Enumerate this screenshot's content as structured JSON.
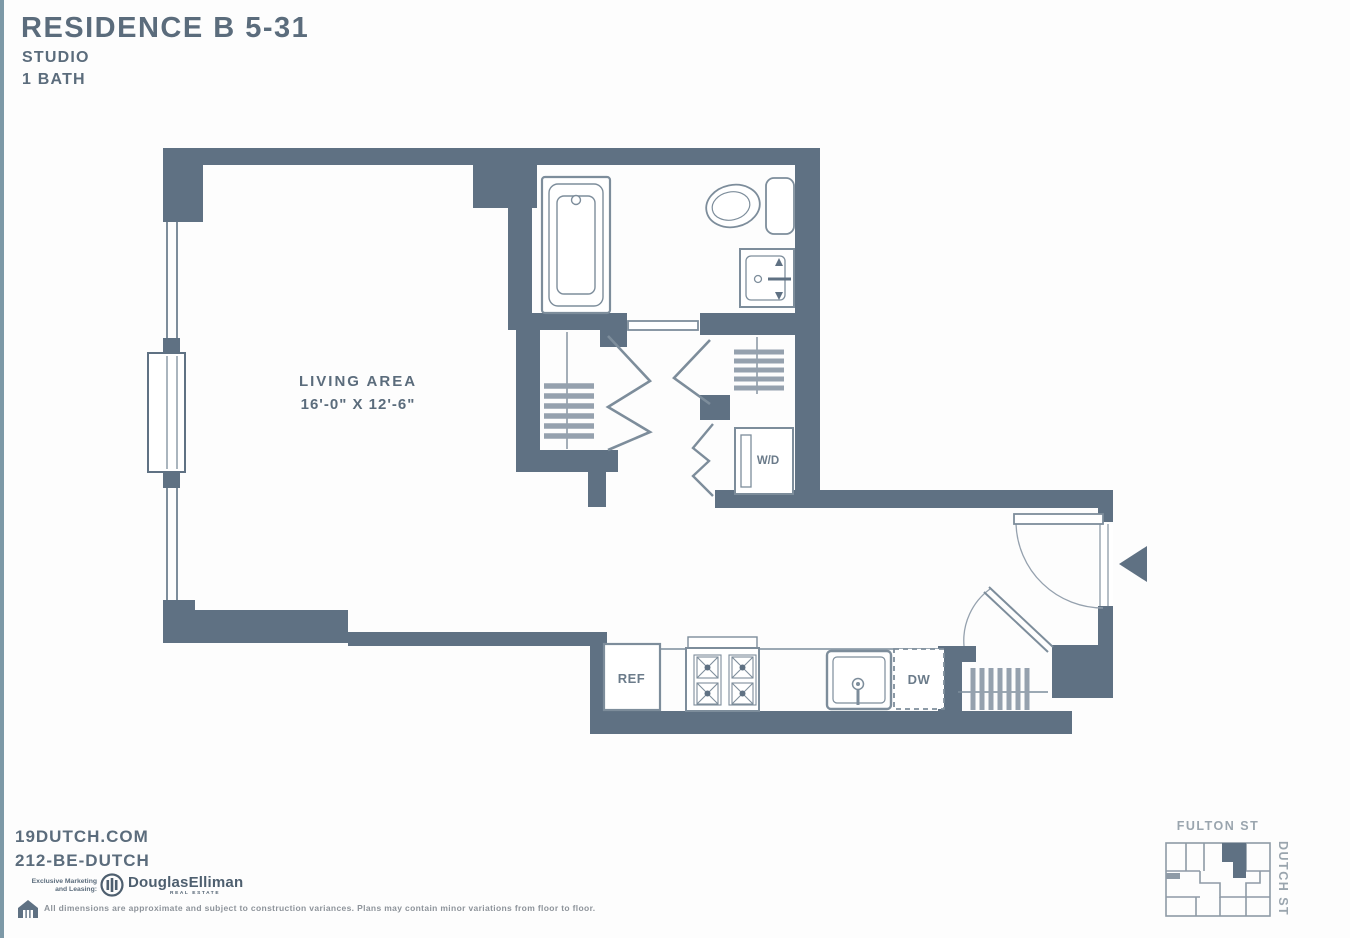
{
  "title": {
    "line1": "RESIDENCE B 5-31",
    "line2": "STUDIO",
    "line3": "1 BATH"
  },
  "plan": {
    "living_label": "LIVING AREA",
    "living_dims": "16'-0\" X 12'-6\"",
    "wd_label": "W/D",
    "ref_label": "REF",
    "dw_label": "DW"
  },
  "key_plan": {
    "street_top": "FULTON ST",
    "street_side": "DUTCH ST"
  },
  "footer": {
    "website": "19DUTCH.COM",
    "phone": "212-BE-DUTCH",
    "marketing_line1": "Exclusive Marketing",
    "marketing_line2": "and Leasing:",
    "broker_name": "DouglasElliman",
    "broker_tagline": "REAL ESTATE",
    "disclaimer": "All dimensions are approximate and subject to construction variances. Plans may contain minor variations from floor to floor."
  },
  "colors": {
    "wall": "#5f7183",
    "text": "#5b6c7c",
    "fixture": "#7d8d9b",
    "light_text": "#9aa5ae"
  }
}
